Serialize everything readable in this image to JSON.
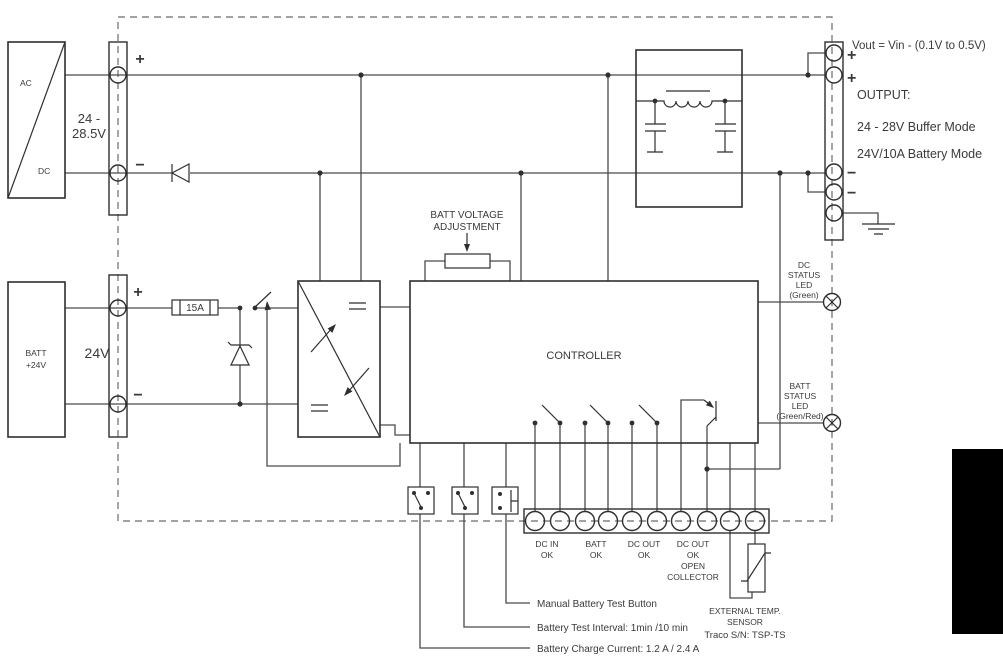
{
  "diagram": {
    "ac_dc_converter": {
      "top_label": "AC",
      "bottom_label": "DC"
    },
    "input": {
      "voltage_line1": "24 -",
      "voltage_line2": "28.5V",
      "plus": "+",
      "minus": "−"
    },
    "battery": {
      "block_line1": "BATT",
      "block_line2": "+24V",
      "voltage": "24V",
      "plus": "+",
      "minus": "−"
    },
    "fuse": {
      "label": "15A"
    },
    "pot": {
      "label_line1": "BATT VOLTAGE",
      "label_line2": "ADJUSTMENT"
    },
    "controller": {
      "label": "CONTROLLER"
    },
    "output": {
      "vout_note": "Vout = Vin - (0.1V to 0.5V)",
      "title": "OUTPUT:",
      "mode1": "24 - 28V Buffer Mode",
      "mode2": "24V/10A Battery Mode",
      "plus1": "+",
      "plus2": "+",
      "minus1": "−",
      "minus2": "−"
    },
    "leds": {
      "dc_status": [
        "DC",
        "STATUS",
        "LED",
        "(Green)"
      ],
      "batt_status": [
        "BATT",
        "STATUS",
        "LED",
        "(Green/Red)"
      ]
    },
    "signal_terminals": {
      "dc_in_ok": [
        "DC IN",
        "OK"
      ],
      "batt_ok": [
        "BATT",
        "OK"
      ],
      "dc_out_ok": [
        "DC OUT",
        "OK"
      ],
      "dc_out_oc": [
        "DC OUT",
        "OK",
        "OPEN",
        "COLLECTOR"
      ]
    },
    "temp_sensor": {
      "line1": "EXTERNAL TEMP.",
      "line2": "SENSOR",
      "line3": "Traco S/N: TSP-TS"
    },
    "settings": {
      "manual_test": "Manual Battery Test Button",
      "test_interval": "Battery Test Interval: 1min /10 min",
      "charge_current": "Battery Charge Current: 1.2 A / 2.4 A"
    }
  }
}
